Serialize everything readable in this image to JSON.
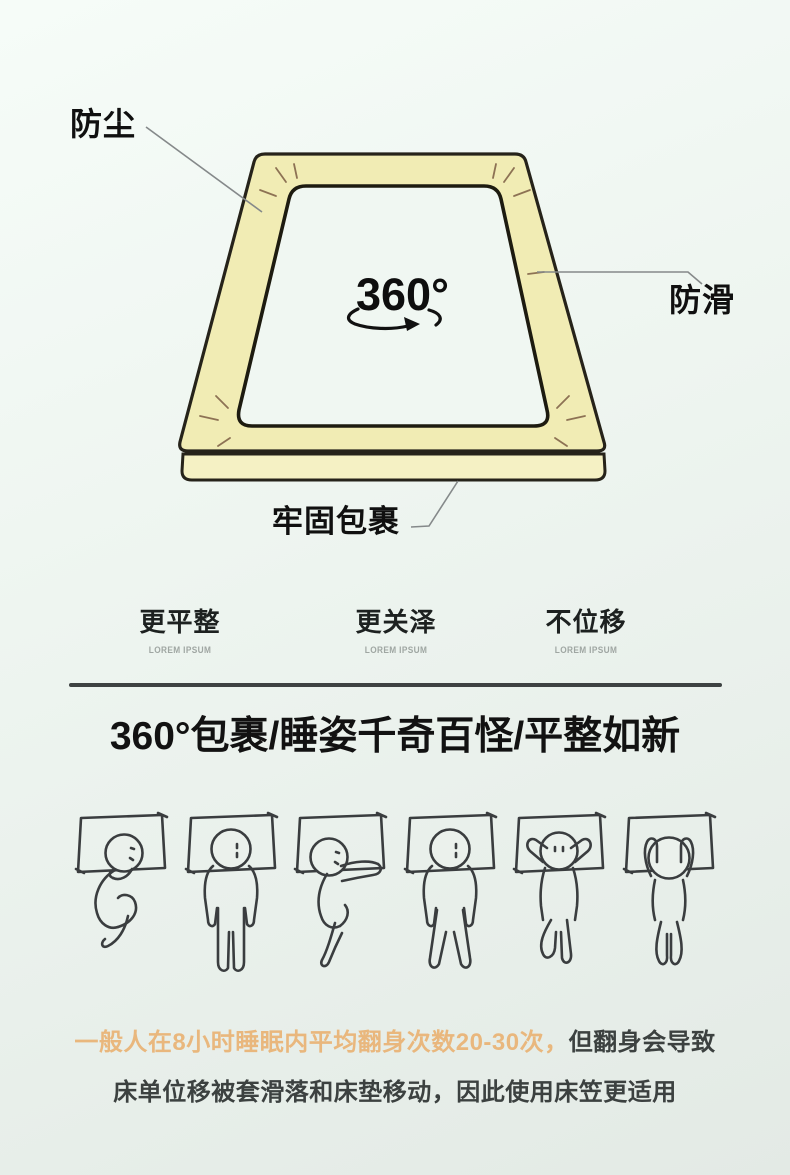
{
  "diagram": {
    "label_dustproof": "防尘",
    "label_antislip": "防滑",
    "label_wrap": "牢固包裹",
    "rotation_label": "360°",
    "sheet_fill_color": "#f1ecb4",
    "sheet_outline_color": "#26231a",
    "crease_color": "#8d7254",
    "leader_color": "#85898a",
    "inner_fill_color": "#f0f7f2"
  },
  "features": [
    {
      "label": "更平整",
      "sub": "LOREM IPSUM"
    },
    {
      "label": "更关泽",
      "sub": "LOREM IPSUM"
    },
    {
      "label": "不位移",
      "sub": "LOREM IPSUM"
    }
  ],
  "headline": "360°包裹/睡姿千奇百怪/平整如新",
  "sleep_poses": [
    "fetal-side-sleeper",
    "back-straight-sleeper",
    "pillow-hug-side-sleeper",
    "back-legs-apart-sleeper",
    "hands-behind-head-sleeper",
    "arms-raised-sleeper"
  ],
  "footer": {
    "line1_highlight": "一般人在8小时睡眠内平均翻身次数20-30次，",
    "line1_rest": "但翻身会导致",
    "line2": "床单位移被套滑落和床垫移动，因此使用床笠更适用",
    "highlight_color": "#e9b77d",
    "text_color": "#3c4140",
    "divider_color": "#3e4242"
  }
}
